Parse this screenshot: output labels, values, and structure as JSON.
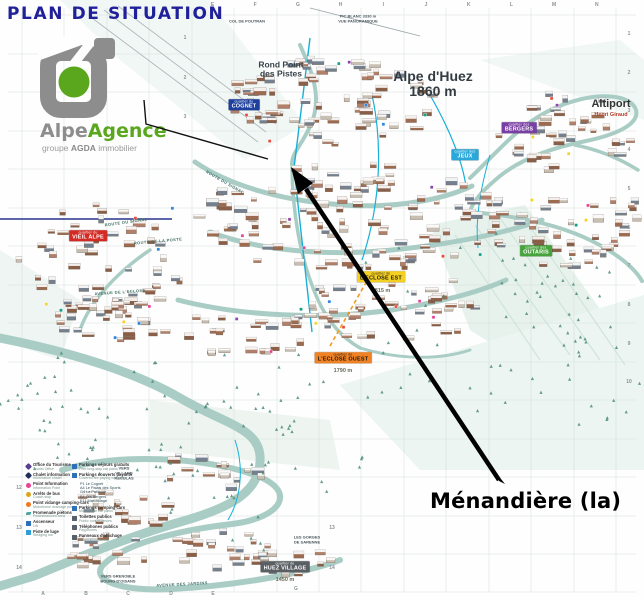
{
  "title": "PLAN DE SITUATION",
  "logo": {
    "brand_gray": "Alpe",
    "brand_green": "Agence",
    "subtitle_prefix": "groupe ",
    "subtitle_bold": "AGDA",
    "subtitle_suffix": " immobilier",
    "gray": "#8d8d8d",
    "green": "#5aa71e"
  },
  "annotation": {
    "label": "Ménandière (la)"
  },
  "map": {
    "summit_label": {
      "line1": "Alpe d'Huez",
      "line2": "1860 m"
    },
    "rond_point": {
      "line1": "Rond Point",
      "line2": "des Pistes"
    },
    "altiport": {
      "name": "Altiport",
      "sub": "Henri Giraud"
    },
    "quarters": [
      {
        "prefix": "quartier du",
        "name": "COGNET",
        "bg": "#1e3f9e",
        "fg": "#ffffff",
        "x": 244,
        "y": 105
      },
      {
        "prefix": "quartier du",
        "name": "VIEIL ALPE",
        "bg": "#d42a24",
        "fg": "#ffffff",
        "x": 88,
        "y": 236
      },
      {
        "prefix": "quartier des",
        "name": "JEUX",
        "bg": "#28a7d8",
        "fg": "#ffffff",
        "x": 465,
        "y": 155
      },
      {
        "prefix": "quartier des",
        "name": "BERGERS",
        "bg": "#7a3fa5",
        "fg": "#ffffff",
        "x": 519,
        "y": 128
      },
      {
        "prefix": "quartier des",
        "name": "OUTARIS",
        "bg": "#47a43c",
        "fg": "#ffffff",
        "x": 536,
        "y": 251
      },
      {
        "prefix": "quartier de",
        "name": "L'ECLOSE EST",
        "bg": "#f5d020",
        "fg": "#1a1a1a",
        "x": 381,
        "y": 277,
        "alt": "1815 m",
        "alt_y": 291
      },
      {
        "prefix": "quartier de",
        "name": "L'ECLOSE OUEST",
        "bg": "#f08224",
        "fg": "#1a1a1a",
        "x": 343,
        "y": 358,
        "alt": "1790 m",
        "alt_y": 371
      },
      {
        "prefix": "quartier de",
        "name": "HUEZ VILLAGE",
        "bg": "#5a5f63",
        "fg": "#ffffff",
        "x": 285,
        "y": 567,
        "alt": "1450 m",
        "alt_y": 580
      }
    ],
    "small_labels": [
      {
        "text": "COL DE POUTRAN",
        "x": 247,
        "y": 22
      },
      {
        "text": "PIC BLANC 3330 m",
        "x": 358,
        "y": 17
      },
      {
        "text": "VUE PANORAMIQUE",
        "x": 358,
        "y": 22
      },
      {
        "text": "VERS",
        "x": 124,
        "y": 469
      },
      {
        "text": "VILLARD",
        "x": 124,
        "y": 474
      },
      {
        "text": "RECULAS",
        "x": 124,
        "y": 479
      },
      {
        "text": "LES GORGES",
        "x": 307,
        "y": 538
      },
      {
        "text": "DE SARENNE",
        "x": 307,
        "y": 543
      },
      {
        "text": "VERS GRENOBLE",
        "x": 118,
        "y": 577
      },
      {
        "text": "BOURG D'OISANS",
        "x": 118,
        "y": 582
      }
    ],
    "streets": [
      {
        "text": "ROUTE DU SIGNAL",
        "x": 126,
        "y": 222,
        "rot": -8
      },
      {
        "text": "ROUTE DE LA POSTE",
        "x": 158,
        "y": 241,
        "rot": -5
      },
      {
        "text": "ROUTE DU SIGNAL",
        "x": 225,
        "y": 182,
        "rot": 30
      },
      {
        "text": "AVENUE DE L'ECLOSE",
        "x": 120,
        "y": 292,
        "rot": -4
      },
      {
        "text": "AVENUE DES JARDINS",
        "x": 182,
        "y": 584,
        "rot": -3
      }
    ],
    "grid": {
      "top_letters": [
        "E",
        "F",
        "G",
        "H",
        "I",
        "J",
        "K",
        "L",
        "M",
        "N"
      ],
      "bottom_letters": [
        "A",
        "B",
        "C",
        "D",
        "E",
        "G"
      ],
      "right_rows": [
        "1",
        "2",
        "3",
        "4",
        "5",
        "6",
        "7",
        "8",
        "9",
        "10"
      ],
      "left_rows": [
        "12",
        "13",
        "14"
      ],
      "inner_rows_top": [
        "1",
        "2",
        "3"
      ],
      "inner_rows_bottom": [
        "13",
        "14"
      ]
    }
  },
  "legend": {
    "left": [
      {
        "fr": "Office du Tourisme",
        "en": "Tourist Office",
        "color": "#5b3f8f",
        "shape": "diamond"
      },
      {
        "fr": "Chalet information",
        "en": "Information chalet",
        "color": "#1f2d5a",
        "shape": "diamond"
      },
      {
        "fr": "Point Information",
        "en": "Information Point",
        "color": "#e84393",
        "shape": "circle"
      },
      {
        "fr": "Arrêts de bus",
        "en": "Coach stop",
        "color": "#d9a520",
        "shape": "circle"
      },
      {
        "fr": "Point vidange camping-cars",
        "en": "Motorhome drainage point",
        "color": "#f07820",
        "shape": "circle"
      },
      {
        "fr": "Promenade piétons",
        "en": "Pedestrianized area",
        "color": "#4fa8a0",
        "shape": "wave"
      },
      {
        "fr": "Ascenseur",
        "en": "Lift",
        "color": "#2e6fb8",
        "shape": "square"
      },
      {
        "fr": "Piste de luge",
        "en": "Sledging run",
        "color": "#2e9ed8",
        "shape": "square"
      }
    ],
    "right": [
      {
        "fr": "Parkings séjours gratuits",
        "en": "Free long-stay car parks",
        "color": "#2e6fb8",
        "shape": "square"
      },
      {
        "fr": "Parkings couverts payants",
        "en": "Covered fee-paying car parks",
        "color": "#2e6fb8",
        "shape": "square",
        "list": [
          "P1 Le Cognet",
          "A4 Le Palais des Sports",
          "G4 La Patinoire",
          "B4 Les Bergers",
          "E11 Marchillage"
        ]
      },
      {
        "fr": "Parkings camping-cars",
        "en": "Motorhome car parks",
        "color": "#2e6fb8",
        "shape": "square"
      },
      {
        "fr": "Toilettes publics",
        "en": "Public conveniences",
        "color": "#55606a",
        "shape": "square"
      },
      {
        "fr": "Téléphones publics",
        "en": "Payphones",
        "color": "#55606a",
        "shape": "square"
      },
      {
        "fr": "Panneaux d'affichage",
        "en": "Information panels",
        "color": "#55606a",
        "shape": "square"
      }
    ]
  }
}
